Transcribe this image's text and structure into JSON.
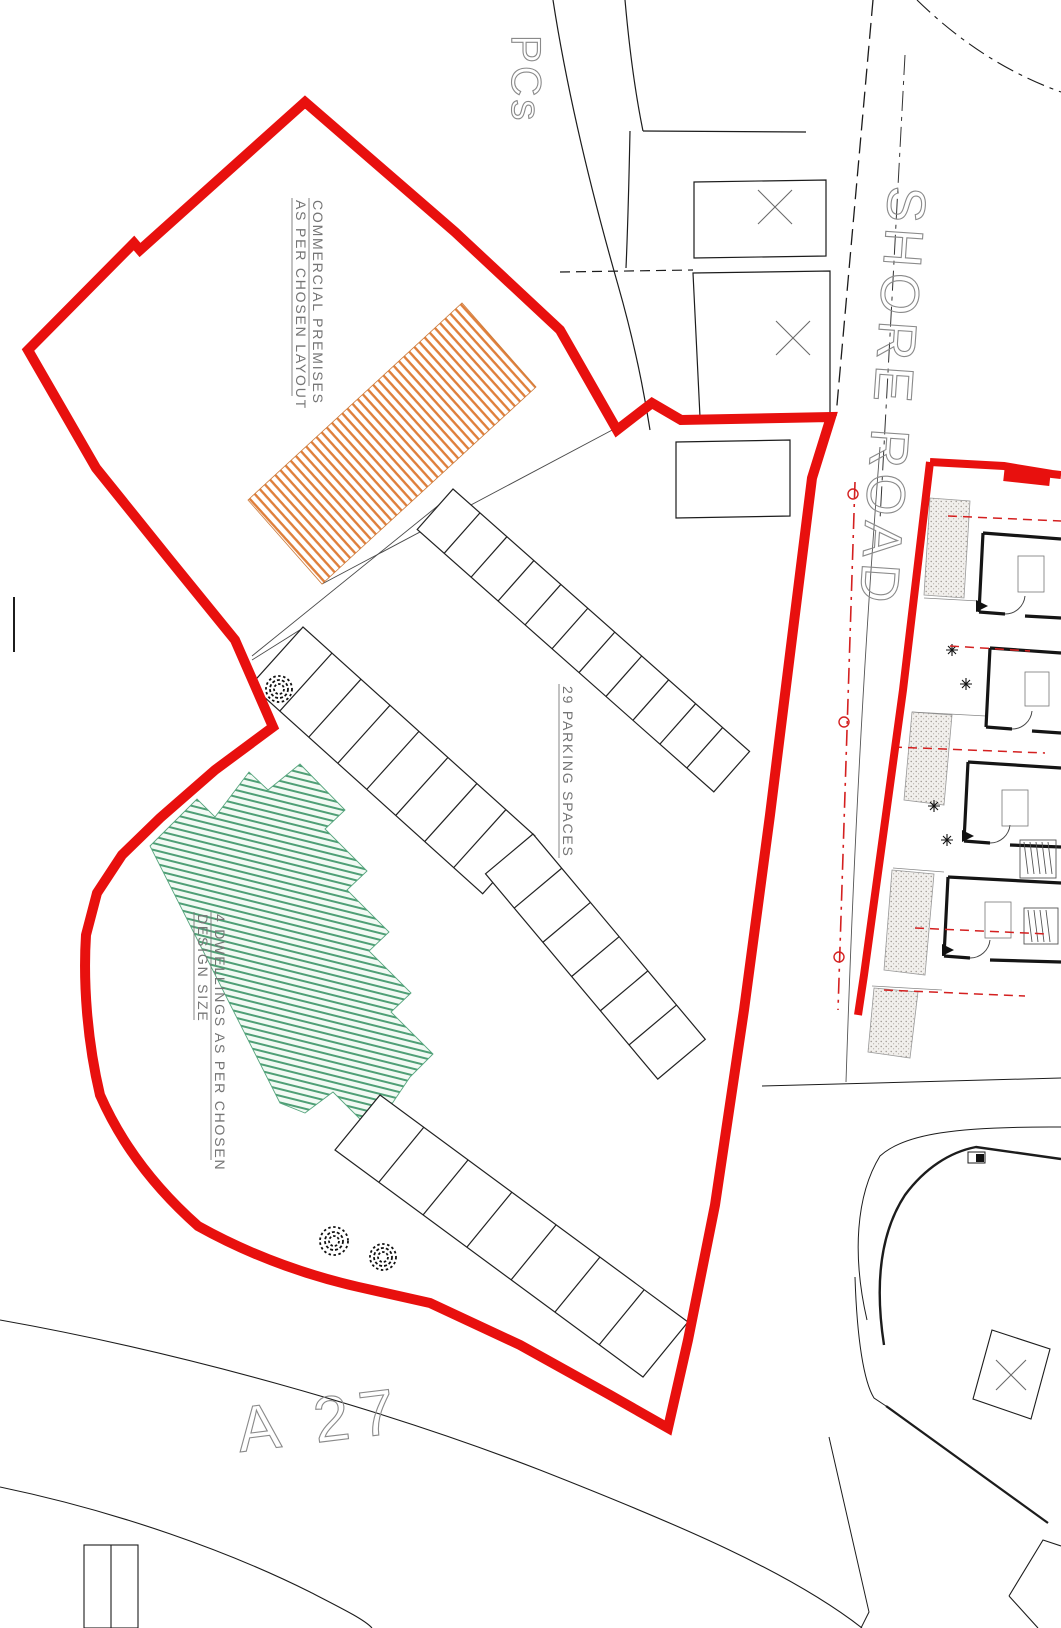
{
  "site": {
    "labels": {
      "pcs": "PCs",
      "shore_road": "SHORE ROAD",
      "a27": "A 27",
      "commercial_line1": "COMMERCIAL PREMISES",
      "commercial_line2": "AS PER CHOSEN LAYOUT",
      "parking": "29 PARKING SPACES",
      "dwellings_line1": "4 DWELLINGS AS PER CHOSEN",
      "dwellings_line2": "DESIGN SIZE"
    },
    "counts": {
      "parking_spaces": 29,
      "dwellings": 4
    },
    "colors": {
      "site_boundary_red": "#e8100e",
      "commercial_hatch_orange": "#df7f3b",
      "dwellings_hatch_green": "#4f9f76",
      "detail_plan_red": "#d42020",
      "drawing_line_black": "#1c1c1c",
      "cad_text_gray": "#757575"
    }
  }
}
